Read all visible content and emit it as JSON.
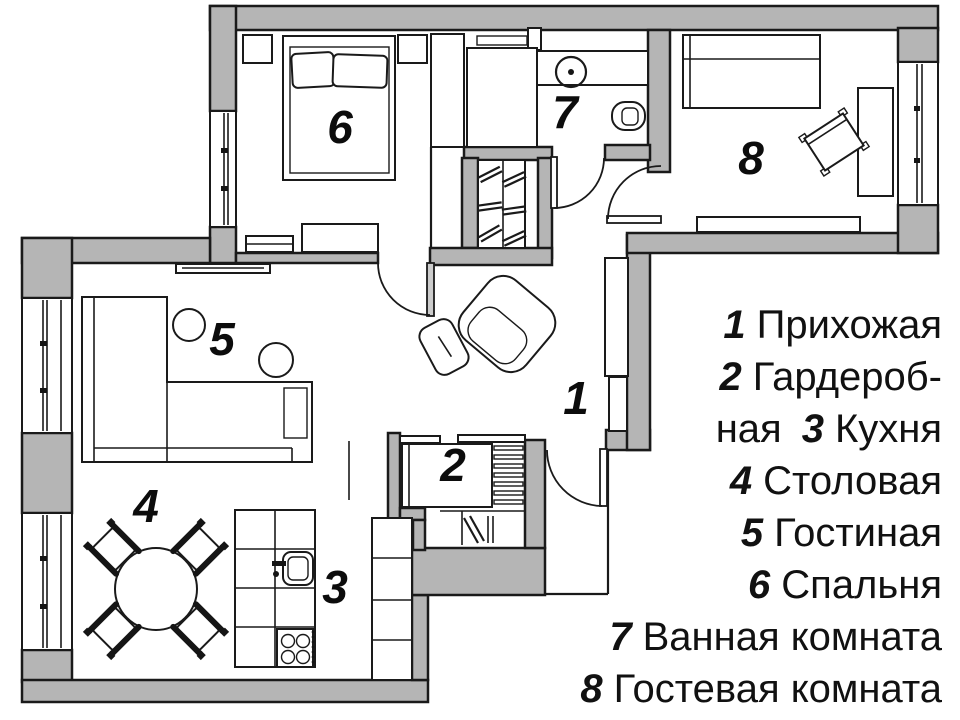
{
  "figure_type": "apartment floor plan",
  "colors": {
    "background": "#ffffff",
    "wall_fill": "#b5b5b5",
    "line": "#1a1a1a",
    "text": "#111111"
  },
  "rooms": [
    {
      "number": "1",
      "name": "Прихожая"
    },
    {
      "number": "2",
      "name": "Гардеробная"
    },
    {
      "number": "3",
      "name": "Кухня"
    },
    {
      "number": "4",
      "name": "Столовая"
    },
    {
      "number": "5",
      "name": "Гостиная"
    },
    {
      "number": "6",
      "name": "Спальня"
    },
    {
      "number": "7",
      "name": "Ванная комната"
    },
    {
      "number": "8",
      "name": "Гостевая комната"
    }
  ],
  "legend_lines": [
    {
      "pre": "",
      "num": "1",
      "text": "Прихожая"
    },
    {
      "pre": "",
      "num": "2",
      "text": "Гардероб-"
    },
    {
      "pre": "ная",
      "num": "3",
      "text": "Кухня"
    },
    {
      "pre": "",
      "num": "4",
      "text": "Столовая"
    },
    {
      "pre": "",
      "num": "5",
      "text": "Гостиная"
    },
    {
      "pre": "",
      "num": "6",
      "text": "Спальня"
    },
    {
      "pre": "",
      "num": "7",
      "text": "Ванная комната"
    },
    {
      "pre": "",
      "num": "8",
      "text": "Гостевая комната"
    }
  ]
}
